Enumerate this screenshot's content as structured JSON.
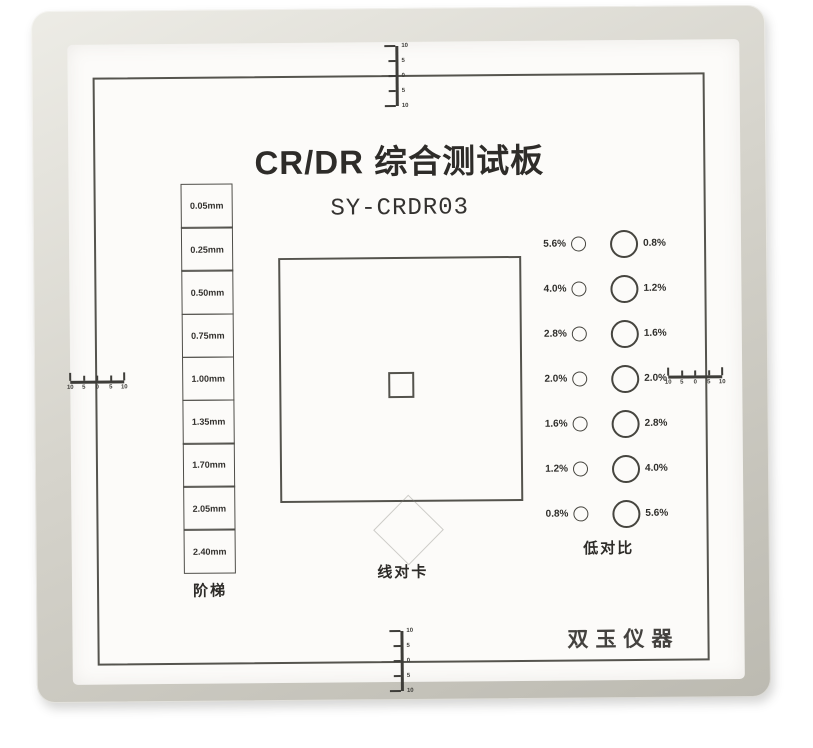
{
  "board": {
    "title": "CR/DR 综合测试板",
    "model": "SY-CRDR03",
    "brand": "双玉仪器",
    "labels": {
      "step_wedge": "阶梯",
      "line_pair": "线对卡",
      "low_contrast": "低对比"
    },
    "step_wedge": {
      "values": [
        "0.05mm",
        "0.25mm",
        "0.50mm",
        "0.75mm",
        "1.00mm",
        "1.35mm",
        "1.70mm",
        "2.05mm",
        "2.40mm"
      ]
    },
    "low_contrast": {
      "rows": [
        {
          "left": "5.6%",
          "right": "0.8%"
        },
        {
          "left": "4.0%",
          "right": "1.2%"
        },
        {
          "left": "2.8%",
          "right": "1.6%"
        },
        {
          "left": "2.0%",
          "right": "2.0%"
        },
        {
          "left": "1.6%",
          "right": "2.8%"
        },
        {
          "left": "1.2%",
          "right": "4.0%"
        },
        {
          "left": "0.8%",
          "right": "5.6%"
        }
      ]
    },
    "rulers": {
      "tick_labels": [
        "10",
        "5",
        "0",
        "5",
        "10"
      ]
    },
    "colors": {
      "frame": "#d6d4cc",
      "frame-hi": "#edece6",
      "frame-lo": "#bcbab1",
      "panel": "#fcfbf9",
      "ink": "#2e2c29",
      "line": "#55544e",
      "mark": "#3e3d39"
    }
  }
}
